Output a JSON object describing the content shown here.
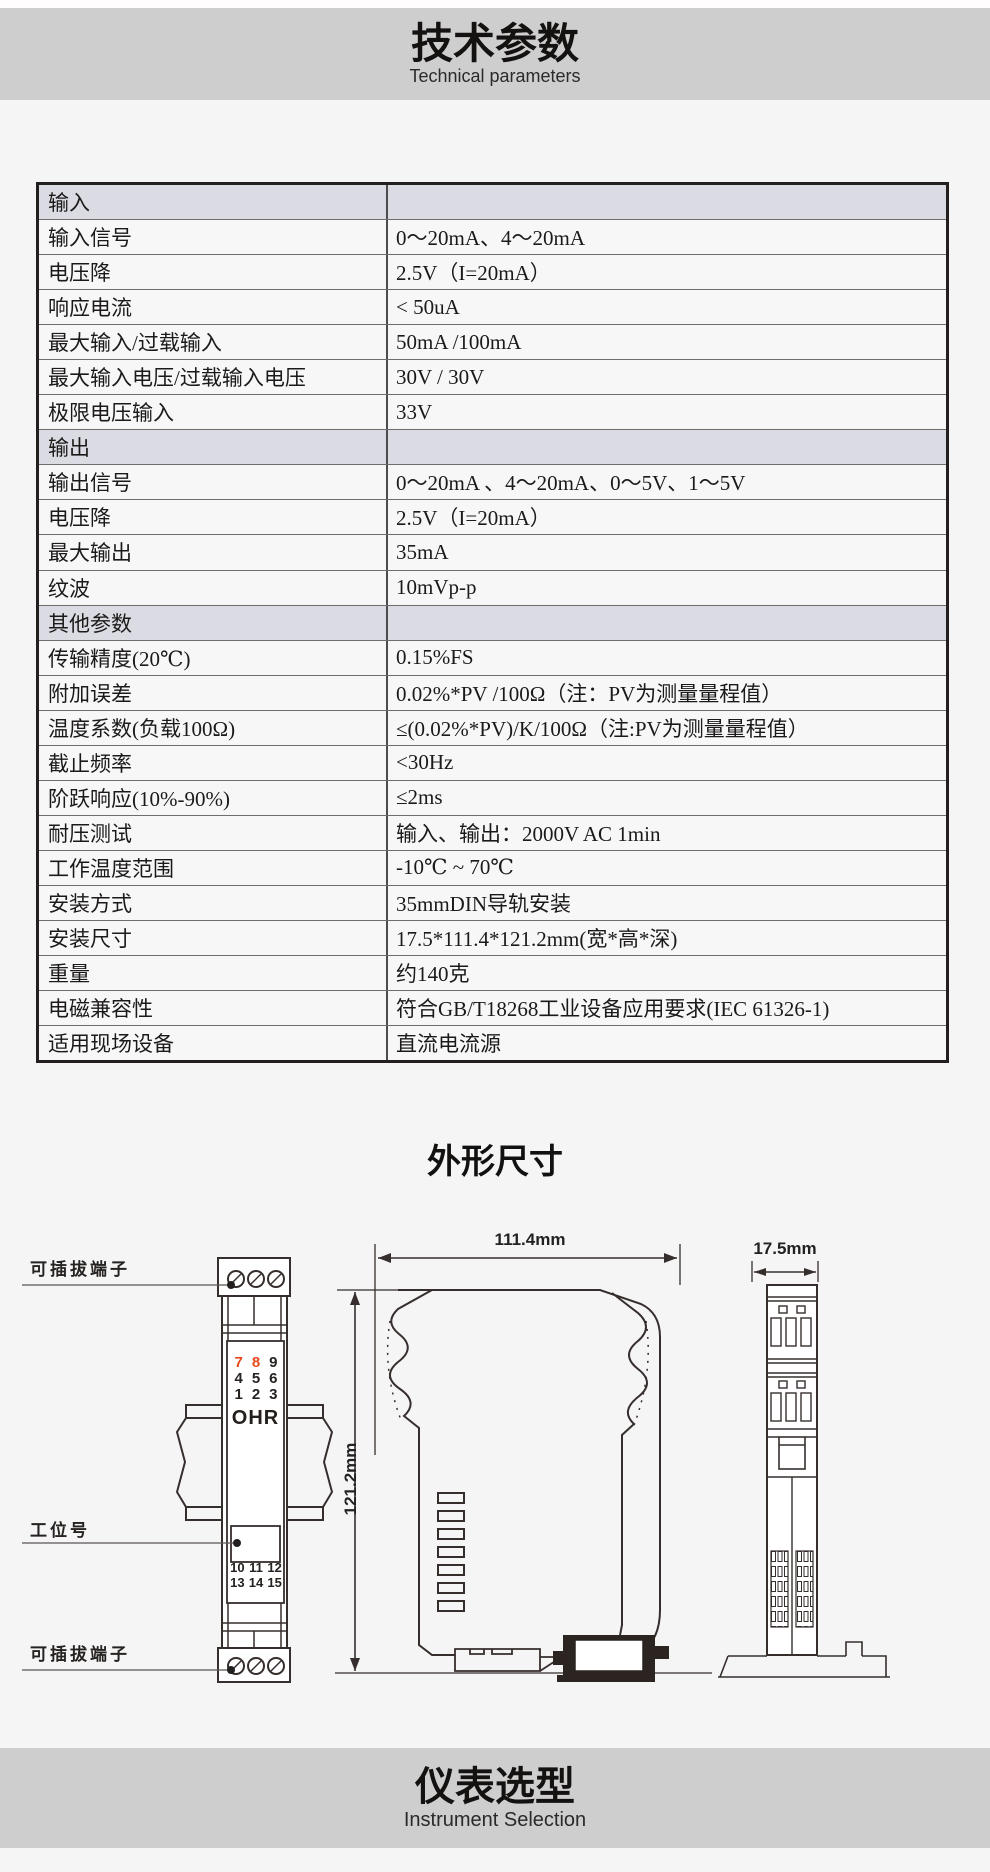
{
  "colors": {
    "page_bg": "#f5f5f6",
    "band_bg": "#cfcecf",
    "table_section_bg": "#dbdce3",
    "table_row_bg": "#f7f7f8",
    "red_accent": "#e8491d",
    "drawing_line": "#362e2c"
  },
  "header": {
    "title": "技术参数",
    "subtitle": "Technical parameters"
  },
  "spec_table": {
    "rows": [
      {
        "label": "输入",
        "value": ""
      },
      {
        "label": "输入信号",
        "value": "0～20mA、4～20mA"
      },
      {
        "label": "电压降",
        "value": "2.5V（I=20mA）"
      },
      {
        "label": "响应电流",
        "value": "< 50uA"
      },
      {
        "label": "最大输入/过载输入",
        "value": "50mA /100mA"
      },
      {
        "label": "最大输入电压/过载输入电压",
        "value": "30V / 30V"
      },
      {
        "label": "极限电压输入",
        "value": "33V"
      },
      {
        "label": "输出",
        "value": ""
      },
      {
        "label": "输出信号",
        "value": "0～20mA 、4～20mA、0～5V、1～5V"
      },
      {
        "label": "电压降",
        "value": "2.5V（I=20mA）"
      },
      {
        "label": "最大输出",
        "value": "35mA"
      },
      {
        "label": "纹波",
        "value": "10mVp-p"
      },
      {
        "label": "其他参数",
        "value": ""
      },
      {
        "label": "传输精度(20℃)",
        "value": "0.15%FS"
      },
      {
        "label": "附加误差",
        "value": "0.02%*PV /100Ω（注：PV为测量量程值）"
      },
      {
        "label": "温度系数(负载100Ω)",
        "value": "≤(0.02%*PV)/K/100Ω（注:PV为测量量程值）"
      },
      {
        "label": "截止频率",
        "value": "<30Hz"
      },
      {
        "label": "阶跃响应(10%-90%)",
        "value": "≤2ms"
      },
      {
        "label": "耐压测试",
        "value": "输入、输出：2000V AC  1min"
      },
      {
        "label": "工作温度范围",
        "value": "-10℃ ~ 70℃"
      },
      {
        "label": "安装方式",
        "value": "35mmDIN导轨安装"
      },
      {
        "label": "安装尺寸",
        "value": "17.5*111.4*121.2mm(宽*高*深)"
      },
      {
        "label": "重量",
        "value": "约140克"
      },
      {
        "label": "电磁兼容性",
        "value": "符合GB/T18268工业设备应用要求(IEC 61326-1)"
      },
      {
        "label": "适用现场设备",
        "value": "直流电流源"
      }
    ]
  },
  "outline": {
    "title": "外形尺寸",
    "labels": {
      "pluggable_top": "可插拔端子",
      "station": "工位号",
      "pluggable_bottom": "可插拔端子"
    },
    "dimensions": {
      "width": "111.4mm",
      "height": "121.2mm",
      "depth": "17.5mm"
    },
    "front": {
      "brand": "OHR",
      "top_terminals": [
        "7",
        "8",
        "9",
        "4",
        "5",
        "6",
        "1",
        "2",
        "3"
      ],
      "bottom_terminals": [
        "10",
        "11",
        "12",
        "13",
        "14",
        "15"
      ]
    }
  },
  "selection": {
    "title": "仪表选型",
    "subtitle": "Instrument Selection"
  }
}
